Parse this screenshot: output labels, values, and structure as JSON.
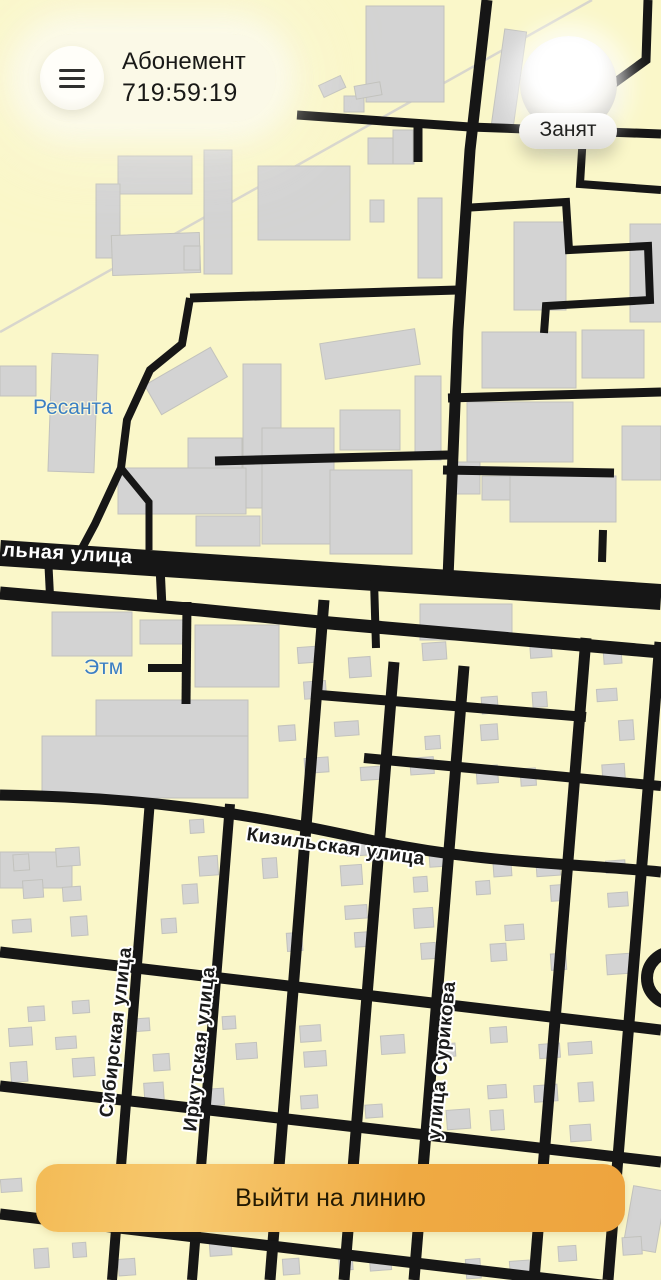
{
  "ui": {
    "menu_chip": {
      "title": "Абонемент",
      "timer": "719:59:19"
    },
    "status_badge": {
      "label": "Занят"
    },
    "go_online_button": {
      "label": "Выйти на линию"
    }
  },
  "map": {
    "poi": [
      {
        "text": "Ресанта"
      },
      {
        "text": "Этм"
      }
    ],
    "streets": {
      "main_partial": "льная улица",
      "kizilskaya": "Кизильская улица",
      "sibirskaya": "Сибирская улица",
      "irkutskaya": "Иркутская улица",
      "surikova": "улица Сурикова"
    }
  },
  "theme": {
    "map_background": "#faf7c9",
    "building_fill": "#d3d3d3",
    "road_color": "#161616",
    "poi_text_color": "#3b7fc4",
    "accent_button_color": "#eda43c"
  }
}
